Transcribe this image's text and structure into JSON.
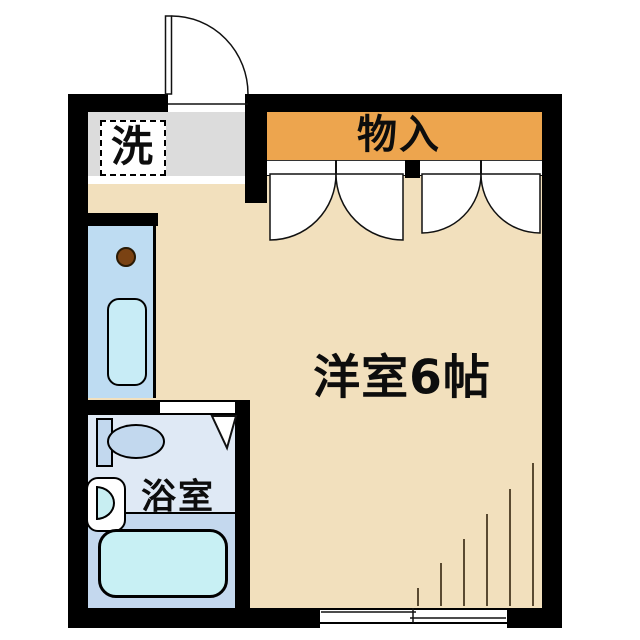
{
  "floor_plan": {
    "labels": {
      "laundry": "洗",
      "storage": "物入",
      "western_room": "洋室6帖",
      "bathroom": "浴室"
    },
    "rooms": [
      {
        "name": "western-room",
        "label": "洋室6帖"
      },
      {
        "name": "bathroom",
        "label": "浴室"
      },
      {
        "name": "storage-closet",
        "label": "物入"
      },
      {
        "name": "laundry-space",
        "label": "洗"
      }
    ],
    "icons": {
      "entrance_door": "quarter-arc-swing-door",
      "closet_doors": "double-french-doors-two-pairs",
      "bathroom_door": "triangle-door-symbol",
      "window": "double-sliding-window",
      "fixtures": [
        "kitchen-counter",
        "gas-burner",
        "kitchen-sink",
        "toilet",
        "washbasin",
        "bathtub"
      ]
    },
    "colors": {
      "wall": "#000000",
      "floor_beige": "#f2e0bd",
      "closet_orange": "#eda54e",
      "hall_gray": "#dcdcdc",
      "kitchen_blue": "#bedcf2",
      "kitchen_sink_cyan": "#c8ecf6",
      "bath_upper_blue": "#dfe9f5",
      "bath_lower_blue": "#c4d8ee",
      "tub_cyan": "#c8f0f4",
      "fixture_blue": "#c2d8ee",
      "burner_brown": "#7a4213",
      "line_black": "#111111"
    }
  }
}
